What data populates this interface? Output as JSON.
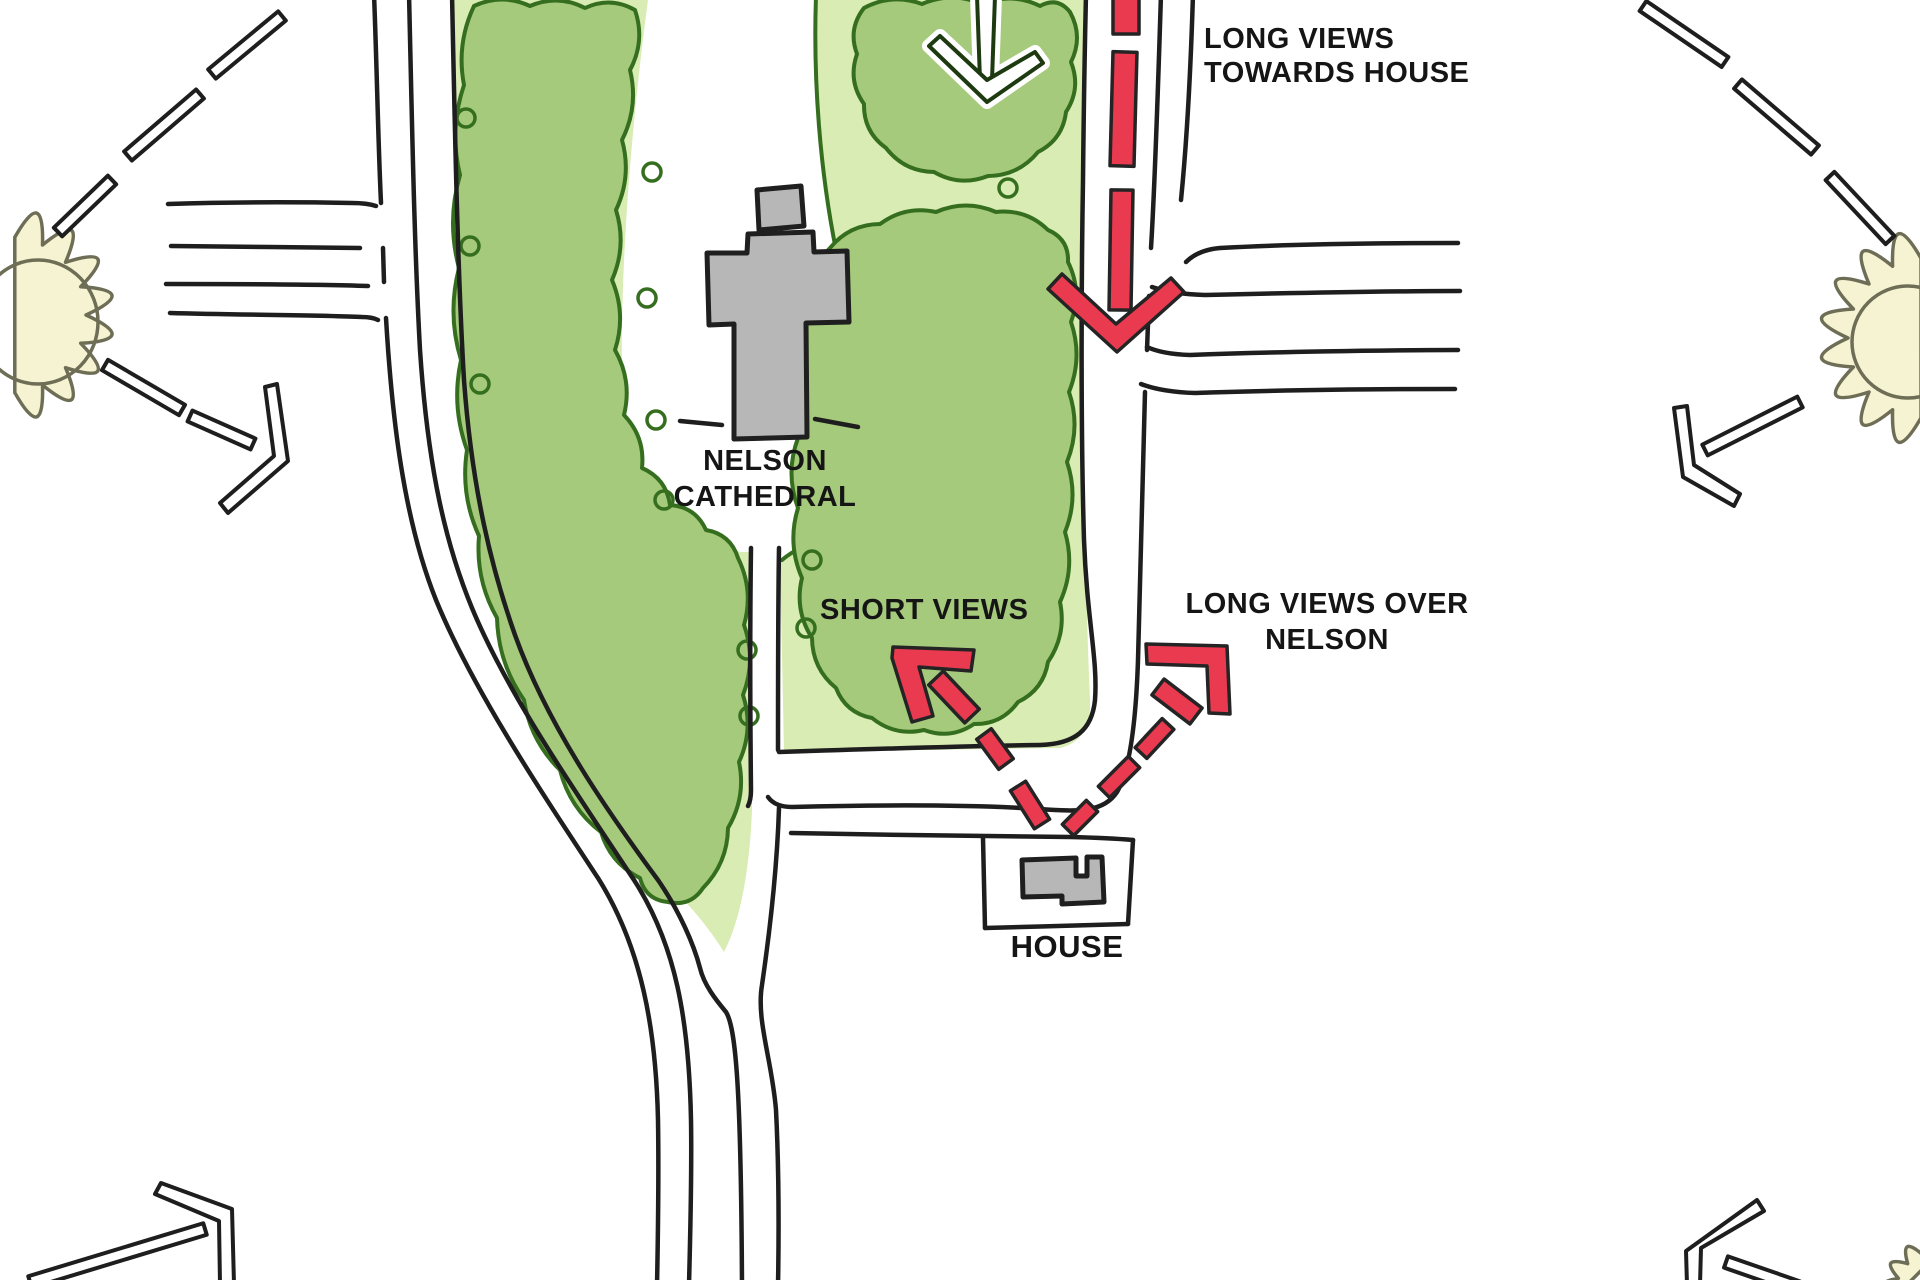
{
  "diagram": {
    "type": "hand-drawn urban design views sketch plan",
    "labels": {
      "long_views_towards_house": "LONG VIEWS\nTOWARDS HOUSE",
      "nelson_cathedral": "NELSON\nCATHEDRAL",
      "short_views": "SHORT VIEWS",
      "long_views_over_nelson": "LONG VIEWS OVER\nNELSON",
      "house": "HOUSE"
    },
    "places": [
      {
        "name": "Nelson Cathedral",
        "kind": "building-cross-footprint"
      },
      {
        "name": "House",
        "kind": "building-in-plot"
      }
    ],
    "view_arrows": [
      {
        "id": "long-views-towards-house",
        "style": "red-dashed",
        "direction": "south"
      },
      {
        "id": "short-views",
        "style": "red-dashed",
        "direction": "northwest"
      },
      {
        "id": "long-views-over-nelson",
        "style": "red-dashed",
        "direction": "northeast"
      }
    ],
    "sketch_arrows": [
      {
        "id": "tree-area-entry-arrow",
        "style": "outlined-white",
        "direction": "south"
      },
      {
        "id": "sun-ray-arrows",
        "style": "outlined-white-dashed",
        "count": 6
      }
    ],
    "colors": {
      "background": "#ffffff",
      "park_light": "#d8ecb4",
      "canopy": "#a5ca7b",
      "canopy_outline": "#356e1e",
      "road_line": "#1e1e1e",
      "building": "#b7b7b7",
      "red": "#ea3a50",
      "sun": "#f6f3d2",
      "sun_outline": "#6e6e57",
      "text": "#151515"
    }
  }
}
